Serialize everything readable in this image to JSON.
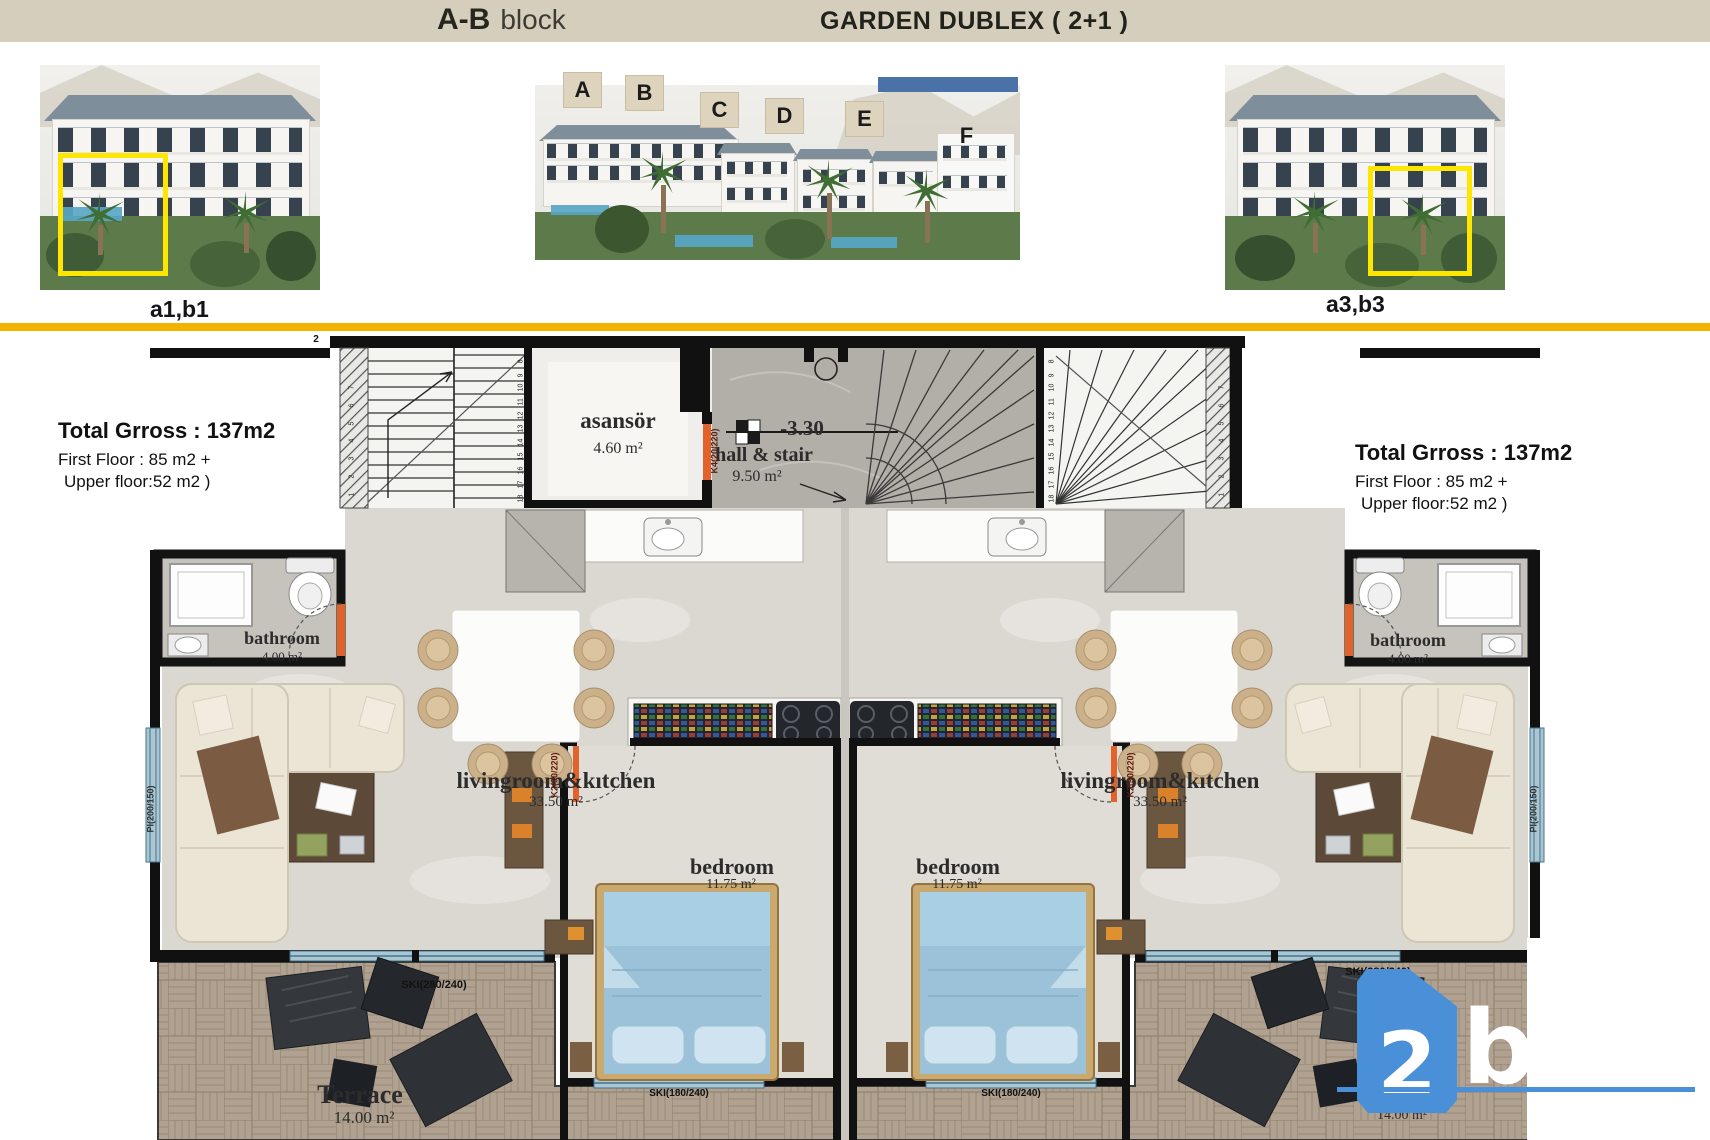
{
  "header": {
    "block_name": "A-B",
    "block_word": "block",
    "title": "GARDEN DUBLEX ( 2+1 )"
  },
  "renders": {
    "left_caption": "a1,b1",
    "right_caption": "a3,b3",
    "block_tags": [
      "A",
      "B",
      "C",
      "D",
      "E",
      "F"
    ]
  },
  "info_left": {
    "total": "Total Grross : 137m2",
    "first": "First Floor : 85 m2 +",
    "upper": "Upper floor:52 m2 )"
  },
  "info_right": {
    "total": "Total Grross : 137m2",
    "first": "First Floor : 85 m2 +",
    "upper": "Upper floor:52 m2 )"
  },
  "plan": {
    "elevator_name": "asansör",
    "elevator_area": "4.60 m²",
    "hall_name": "hall & stair",
    "hall_area": "9.50 m²",
    "hall_elevation": "-3.30",
    "bathroom_name": "bathroom",
    "bathroom_area": "4.00 m²",
    "living_name": "livingroom&kıtchen",
    "living_area": "33.50 m²",
    "bedroom_name": "bedroom",
    "bedroom_area": "11.75 m²",
    "terrace_name": "Terrace",
    "terrace_area": "14.00 m²",
    "top_floor_mark": "2",
    "labels": {
      "window_wide": "SKI(280/240)",
      "window_bedroom": "SKI(180/240)",
      "window_side": "PI(200/150)",
      "door_elevator": "K4(20/220)",
      "door_bedroom": "K2(90/220)"
    },
    "stair_numbers_inner": [
      "8",
      "9",
      "10",
      "11",
      "12",
      "13",
      "14",
      "15",
      "16",
      "17",
      "18"
    ],
    "stair_numbers_outer": [
      "7",
      "6",
      "5",
      "4",
      "3",
      "2",
      "1"
    ]
  },
  "watermark": {
    "number": "2",
    "letter": "b"
  },
  "colors": {
    "accent_yellow": "#f2b400",
    "highlight_yellow": "#ffe600",
    "brand_blue": "#4a90d8",
    "header_beige": "#d6cebc"
  }
}
